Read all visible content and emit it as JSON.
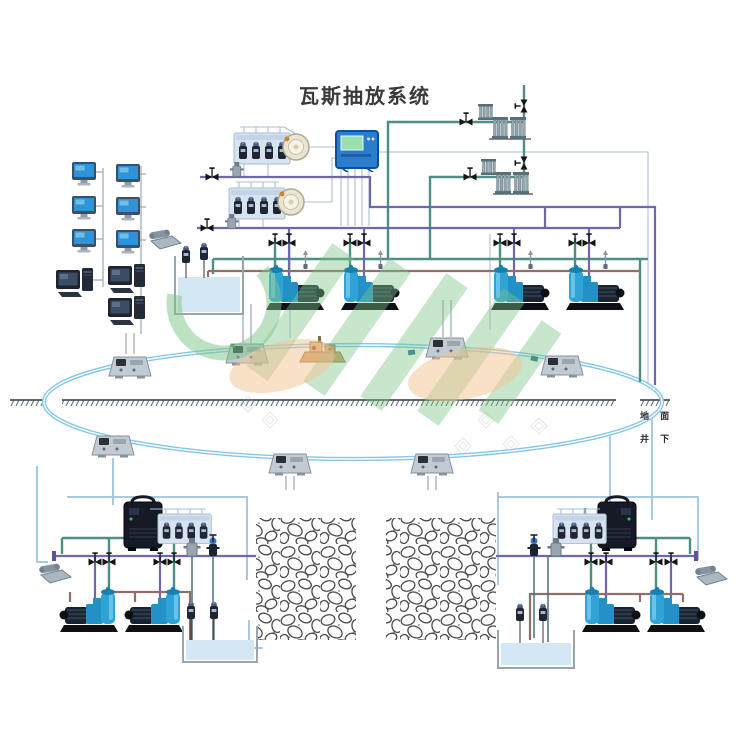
{
  "title": "瓦斯抽放系统",
  "labels": {
    "surface": "地 面",
    "underground": "井 下"
  },
  "colors": {
    "title_color": "#3a3a3a",
    "pipe_teal": "#4e8f85",
    "pipe_purple": "#6f66ad",
    "pipe_brown": "#8f7068",
    "ring_blue": "#85c6e8",
    "cable_gray": "#aec0d0",
    "cable_blue": "#9fc3dd",
    "panel_blue": "#2b7ccc",
    "panel_screen_green": "#9adfae",
    "pump_blue": "#2fa3d6",
    "water_blue": "#d3e7f4",
    "watermark_green": "#7cc487",
    "watermark_orange": "#f5c493"
  },
  "icons": {
    "monitor-icon": "blue CRT monitor on stand",
    "desktop-computer-icon": "dark desktop computer with tower",
    "telephone-icon": "mine telephone set",
    "gas-sensor-icon": "methane sensor cylinder",
    "sensor-tray": "rack of four gas sensors",
    "blower-icon": "round drainage blower",
    "control-panel": "blue monitoring control cabinet with green screen",
    "valve-icon": "black bowtie pipe valve",
    "pump-unit": "water-ring vacuum pump with motor and separator tank",
    "flame-arrester-fins": "finned flame arrester manifold",
    "ring-substation": "monitoring substation on transmission ring",
    "pump-station-model": "tan drainage pump station model",
    "water-tank": "open water tank with level sensors",
    "goaf-rock-area": "caved goaf rock zone",
    "ground-hatch": "surface ground line",
    "watermark-logo": "green and orange CHH watermark"
  }
}
